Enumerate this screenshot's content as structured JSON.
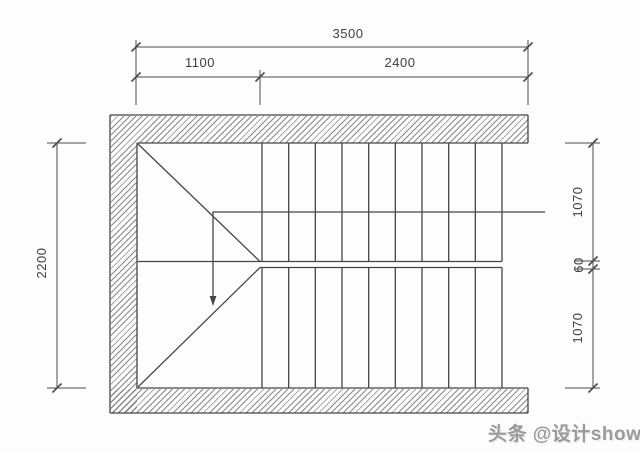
{
  "drawing": {
    "type": "stair-plan",
    "line_color": "#454545",
    "dim_line_color": "#4a4a4a",
    "hatch_color": "#8a8a8a",
    "background_color": "#fdfdfd",
    "text_color": "#3f3f3f",
    "treads": {
      "count": 10,
      "x_start": 262,
      "x_end": 502,
      "upper_flight": {
        "y1": 143.5,
        "y2": 261.5
      },
      "lower_flight": {
        "y1": 267.5,
        "y2": 387.5
      }
    }
  },
  "dimensions": {
    "top_overall": "3500",
    "top_left_segment": "1100",
    "top_right_segment": "2400",
    "left_overall": "2200",
    "right_upper": "1070",
    "right_middle": "60",
    "right_lower": "1070"
  },
  "watermark": {
    "text": "头条 @设计show",
    "color": "#9a9a9a"
  }
}
